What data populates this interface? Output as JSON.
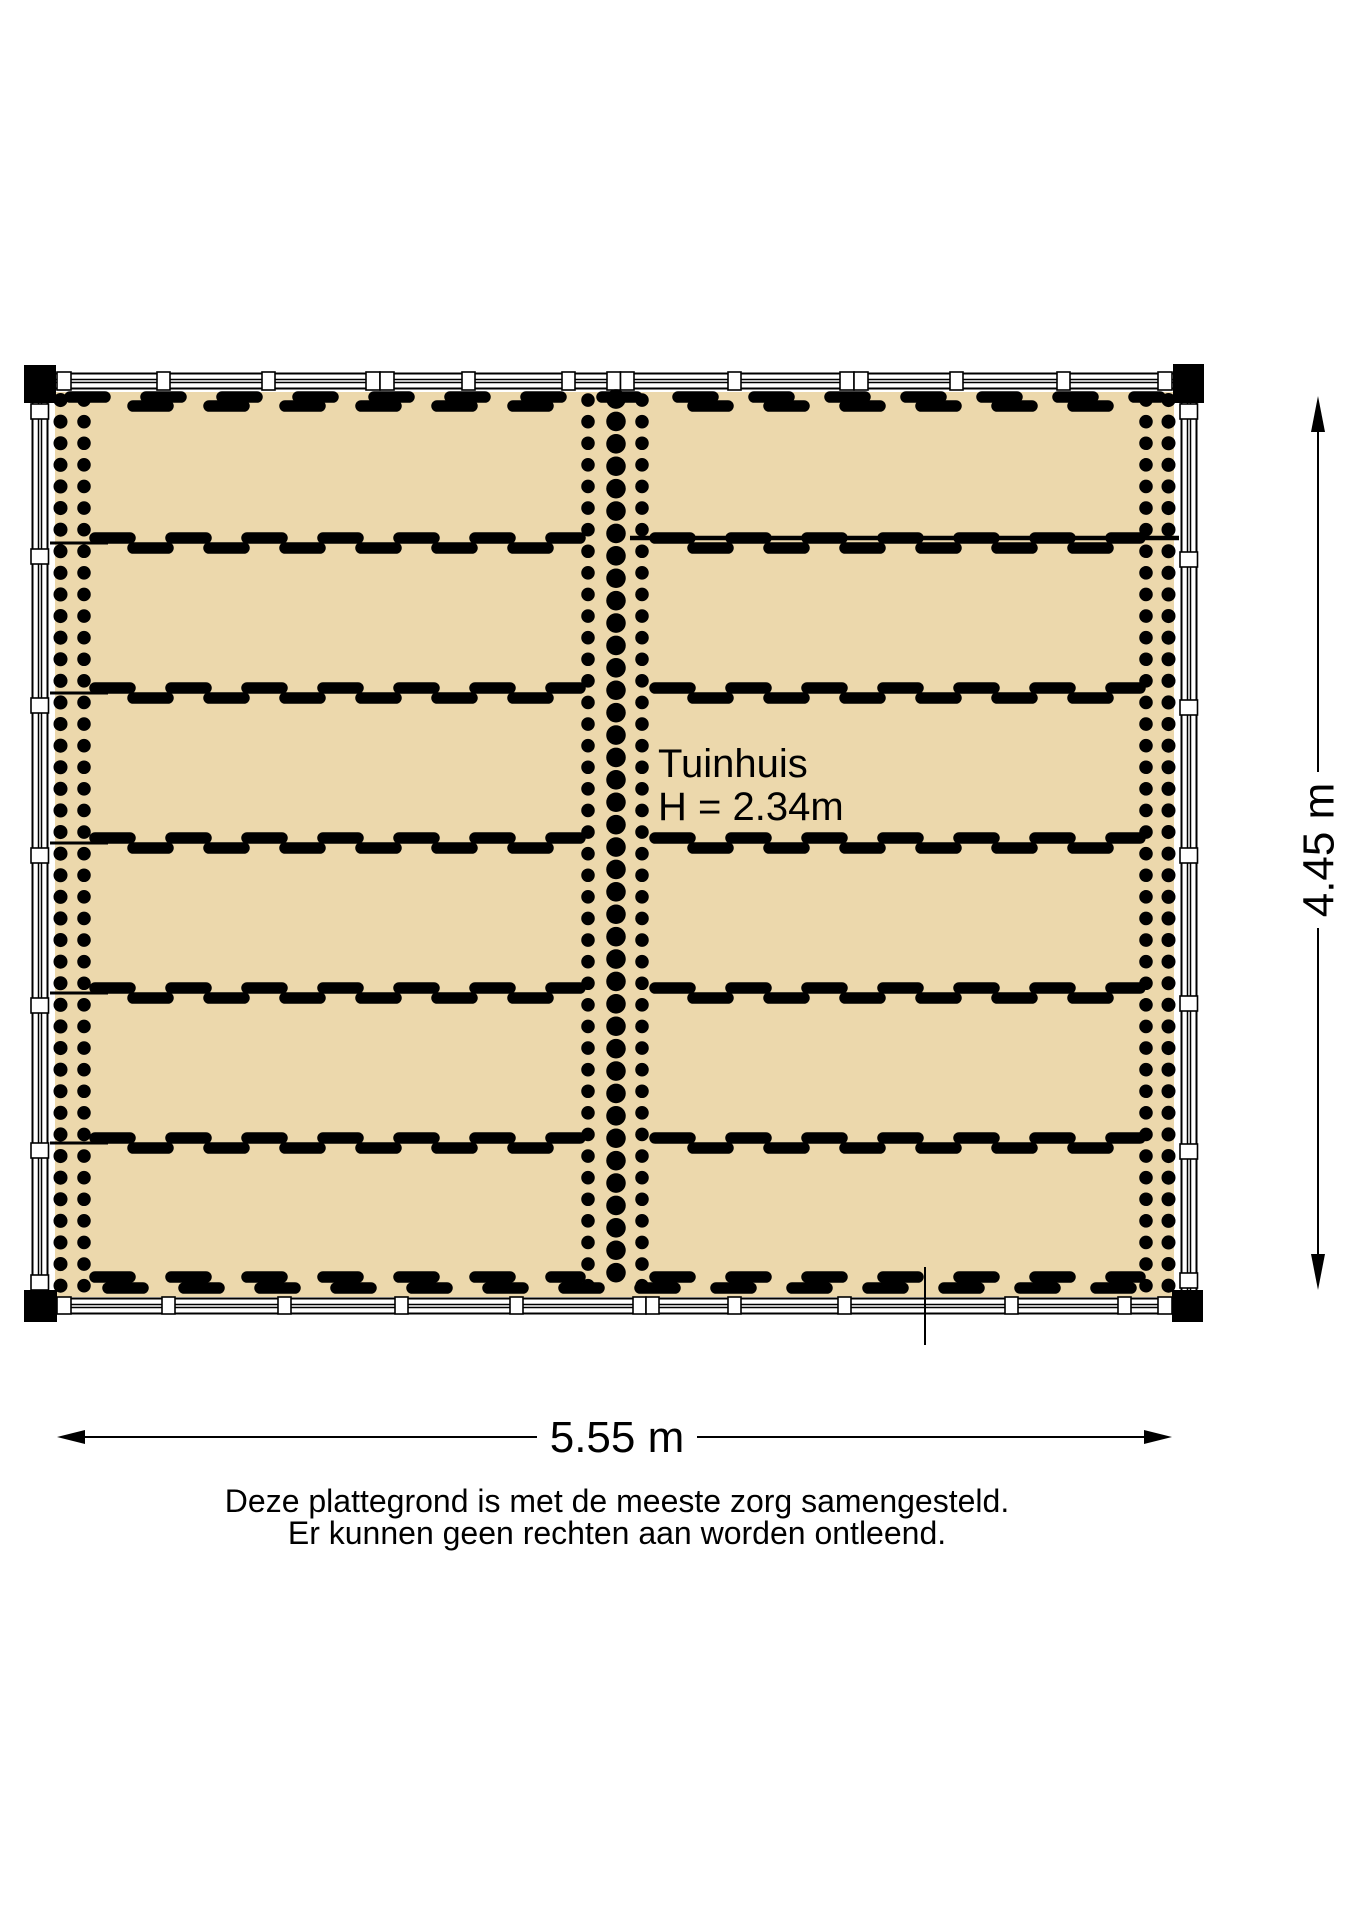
{
  "colors": {
    "floor": "#ecd8ac",
    "line": "#000000",
    "wall_fill": "#ffffff"
  },
  "room": {
    "name": "Tuinhuis",
    "height_label": "H = 2.34m"
  },
  "dimensions": {
    "width_label": "5.55 m",
    "height_label": "4.45 m"
  },
  "disclaimer": {
    "line1": "Deze plattegrond is met de meeste zorg samengesteld.",
    "line2": "Er kunnen geen rechten aan worden ontleend."
  }
}
